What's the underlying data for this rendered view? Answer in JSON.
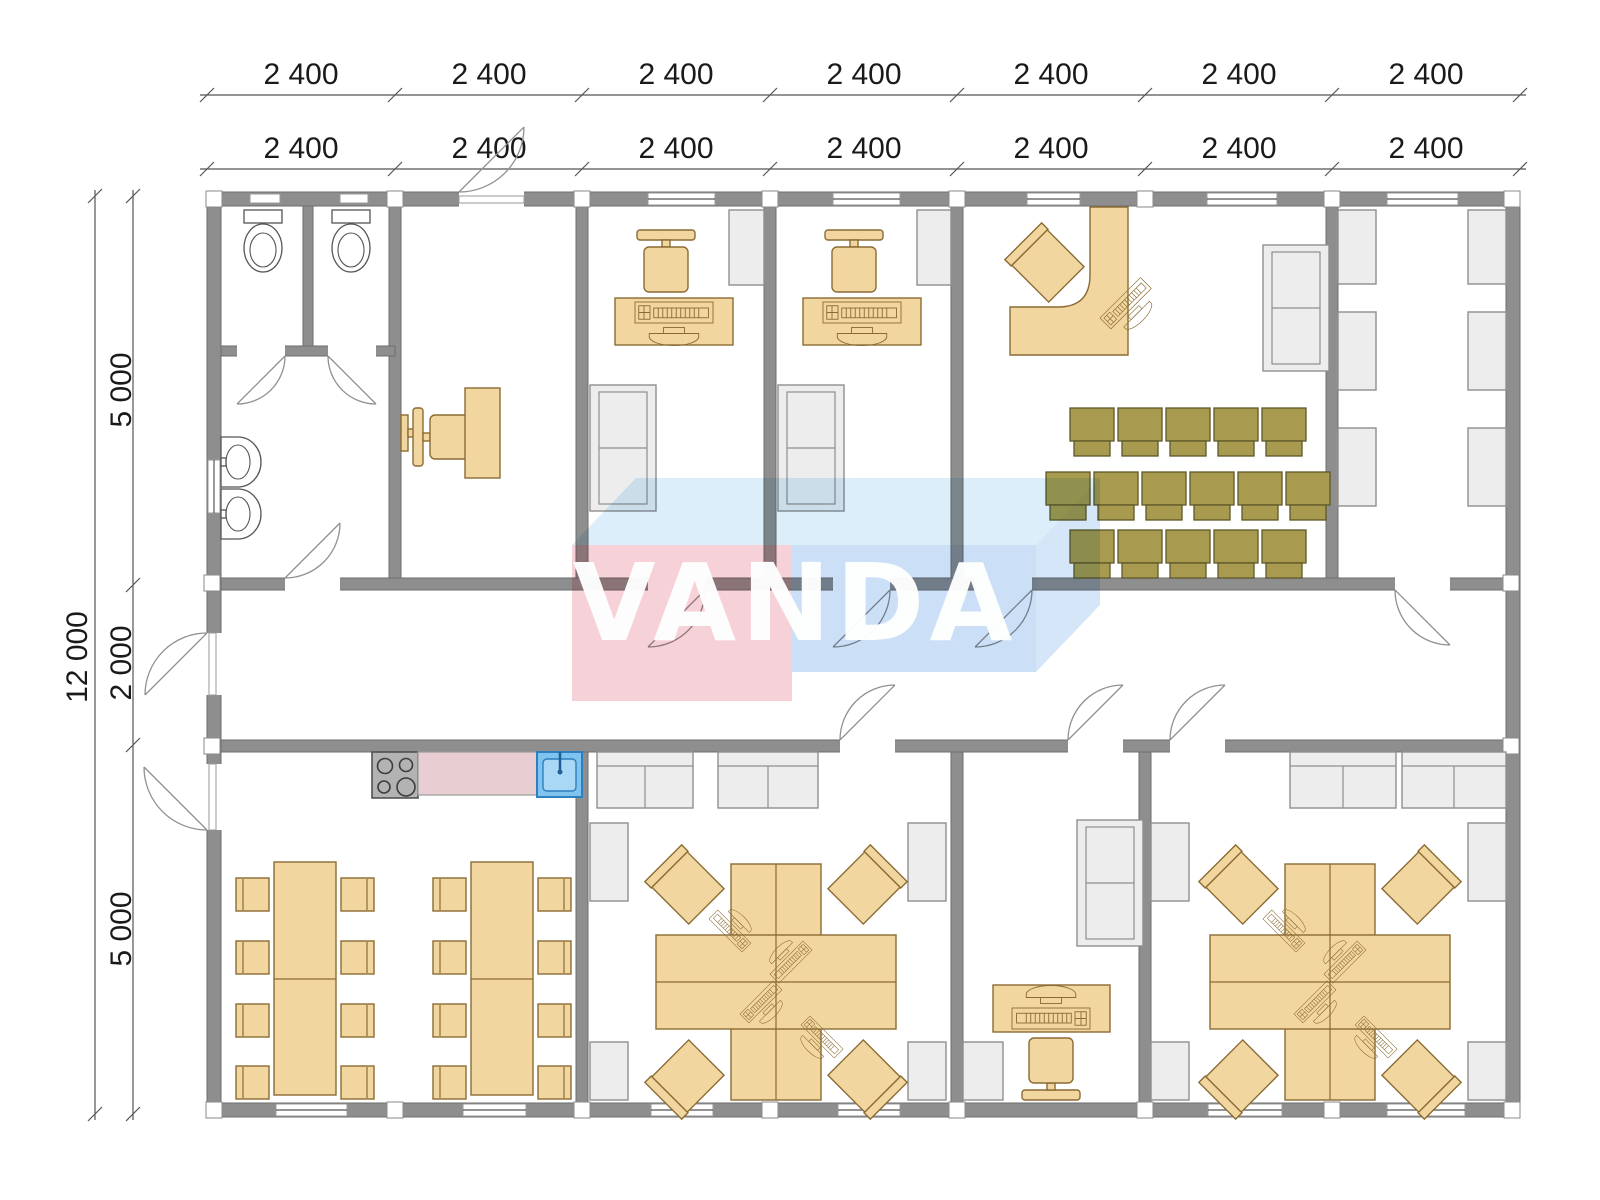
{
  "dimensions": {
    "top_row_outer": [
      "2 400",
      "2 400",
      "2 400",
      "2 400",
      "2 400",
      "2 400",
      "2 400"
    ],
    "top_row_inner": [
      "2 400",
      "2 400",
      "2 400",
      "2 400",
      "2 400",
      "2 400",
      "2 400"
    ],
    "left_total": "12 000",
    "left_segments": [
      "5 000",
      "2 000",
      "5 000"
    ]
  },
  "watermark": {
    "text": "VANDA",
    "pink": "#f7ccd4",
    "blue_front": "#c6ddf5",
    "blue_top": "#d7ecfa"
  },
  "colors": {
    "wall": "#8e8e8e",
    "furniture_wood": "#f2d69f",
    "furniture_gray": "#ededed",
    "chair_olive": "#a89b50",
    "counter_pink": "#e8ced2",
    "sink_blue": "#7fc3ef"
  }
}
